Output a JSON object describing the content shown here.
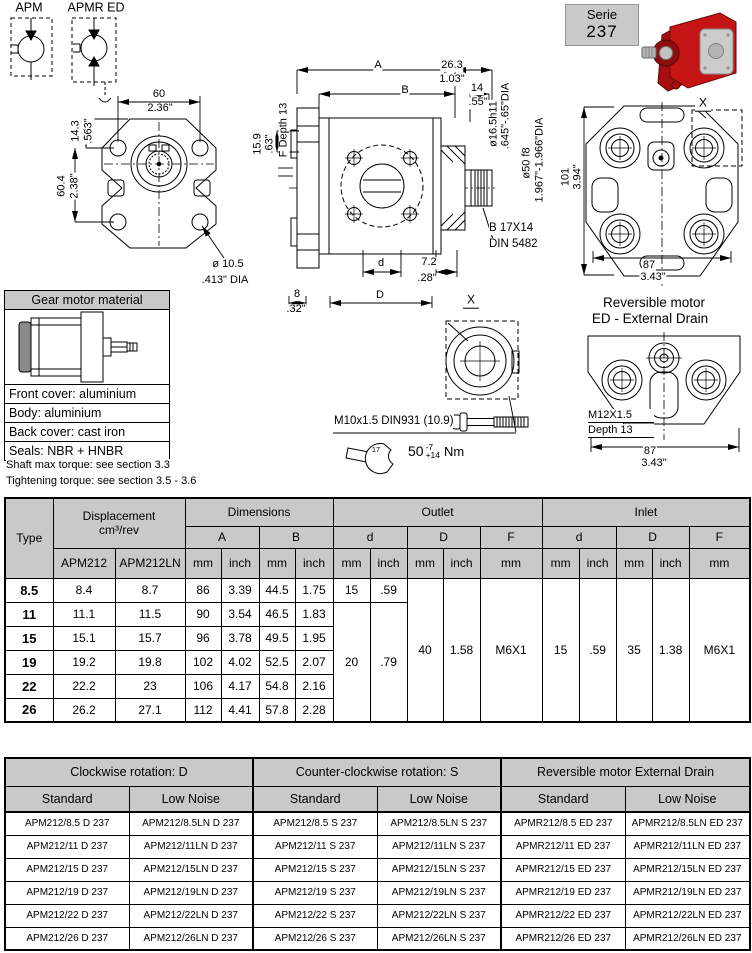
{
  "schematic": {
    "apm_label": "APM",
    "apmr_label": "APMR ED"
  },
  "serie": {
    "label": "Serie",
    "number": "237"
  },
  "front_view": {
    "width_mm": "60",
    "width_in": "2.36\"",
    "offset_mm": "14.3",
    "offset_in": ".563\"",
    "height_mm": "60.4",
    "height_in": "2.38\"",
    "port_offset_mm": "15.9",
    "port_offset_in": ".63\"",
    "f_depth": "F Depth 13",
    "hole_dia_mm": "ø 10.5",
    "hole_dia_in": ".413\" DIA"
  },
  "side_view": {
    "dim_a": "A",
    "dim_b": "B",
    "shaft_ext_mm": "26.3",
    "shaft_ext_in": "1.03\"",
    "spline_len_mm": "14",
    "spline_len_in": ".55\"",
    "shaft_dia": "ø16.5h11",
    "shaft_dia_in": ".645\"-.65\"DIA",
    "pilot_dia": "ø50 f8",
    "pilot_dia_in": "1.967\"-1.966\"DIA",
    "spline_type": "B 17X14",
    "spline_std": "DIN 5482",
    "dim_d": "d",
    "port_depth_mm": "7.2",
    "port_depth_in": ".28\"",
    "base_mm": "8",
    "base_in": ".32\"",
    "dim_D": "D"
  },
  "rear_view": {
    "height_mm": "101",
    "height_in": "3.94\"",
    "width_mm": "87",
    "width_in": "3.43\"",
    "x_label": "X"
  },
  "material_box": {
    "title": "Gear motor material",
    "rows": [
      "Front cover: aluminium",
      "Body: aluminium",
      "Back cover: cast iron",
      "Seals: NBR + HNBR"
    ]
  },
  "notes": {
    "line1": "Shaft max torque: see section 3.3",
    "line2": "Tightening torque: see section 3.5 - 3.6"
  },
  "detail": {
    "x_label": "X",
    "bolt_spec": "M10x1.5 DIN931 (10.9)",
    "wrench_size": "17",
    "torque_value": "50",
    "torque_minus": "-7",
    "torque_plus": "+14",
    "torque_unit": "Nm"
  },
  "reversible": {
    "title_line1": "Reversible motor",
    "title_line2": "ED - External Drain",
    "thread": "M12X1.5",
    "depth": "Depth 13",
    "width_mm": "87",
    "width_in": "3.43\""
  },
  "dim_table": {
    "h_type": "Type",
    "h_displacement": "Displacement",
    "h_displacement_unit": "cm³/rev",
    "h_apm212": "APM212",
    "h_apm212ln": "APM212LN",
    "h_dimensions": "Dimensions",
    "h_outlet": "Outlet",
    "h_inlet": "Inlet",
    "h_a": "A",
    "h_b": "B",
    "h_d": "d",
    "h_D": "D",
    "h_F": "F",
    "h_mm": "mm",
    "h_inch": "inch",
    "rows": [
      {
        "type": "8.5",
        "d1": "8.4",
        "d2": "8.7",
        "a_mm": "86",
        "a_in": "3.39",
        "b_mm": "44.5",
        "b_in": "1.75",
        "od_mm": "15",
        "od_in": ".59"
      },
      {
        "type": "11",
        "d1": "11.1",
        "d2": "11.5",
        "a_mm": "90",
        "a_in": "3.54",
        "b_mm": "46.5",
        "b_in": "1.83"
      },
      {
        "type": "15",
        "d1": "15.1",
        "d2": "15.7",
        "a_mm": "96",
        "a_in": "3.78",
        "b_mm": "49.5",
        "b_in": "1.95"
      },
      {
        "type": "19",
        "d1": "19.2",
        "d2": "19.8",
        "a_mm": "102",
        "a_in": "4.02",
        "b_mm": "52.5",
        "b_in": "2.07"
      },
      {
        "type": "22",
        "d1": "22.2",
        "d2": "23",
        "a_mm": "106",
        "a_in": "4.17",
        "b_mm": "54.8",
        "b_in": "2.16"
      },
      {
        "type": "26",
        "d1": "26.2",
        "d2": "27.1",
        "a_mm": "112",
        "a_in": "4.41",
        "b_mm": "57.8",
        "b_in": "2.28"
      }
    ],
    "merged": {
      "od2_mm": "20",
      "od2_in": ".79",
      "oD_mm": "40",
      "oD_in": "1.58",
      "oF": "M6X1",
      "id_mm": "15",
      "id_in": ".59",
      "iD_mm": "35",
      "iD_in": "1.38",
      "iF": "M6X1"
    }
  },
  "model_table": {
    "group1": "Clockwise rotation: D",
    "group2": "Counter-clockwise rotation: S",
    "group3": "Reversible motor External Drain",
    "sub_standard": "Standard",
    "sub_low_noise": "Low Noise",
    "rows": [
      [
        "APM212/8.5 D 237",
        "APM212/8.5LN D 237",
        "APM212/8.5 S 237",
        "APM212/8.5LN S 237",
        "APMR212/8.5 ED 237",
        "APMR212/8.5LN ED 237"
      ],
      [
        "APM212/11 D 237",
        "APM212/11LN D 237",
        "APM212/11 S 237",
        "APM212/11LN S 237",
        "APMR212/11 ED 237",
        "APMR212/11LN ED 237"
      ],
      [
        "APM212/15 D 237",
        "APM212/15LN D 237",
        "APM212/15 S 237",
        "APM212/15LN S 237",
        "APMR212/15 ED 237",
        "APMR212/15LN ED 237"
      ],
      [
        "APM212/19 D 237",
        "APM212/19LN D 237",
        "APM212/19 S 237",
        "APM212/19LN S 237",
        "APMR212/19 ED 237",
        "APMR212/19LN ED 237"
      ],
      [
        "APM212/22 D 237",
        "APM212/22LN D 237",
        "APM212/22 S 237",
        "APM212/22LN S 237",
        "APMR212/22 ED 237",
        "APMR212/22LN ED 237"
      ],
      [
        "APM212/26 D 237",
        "APM212/26LN D 237",
        "APM212/26 S 237",
        "APM212/26LN S 237",
        "APMR212/26 ED 237",
        "APMR212/26LN ED 237"
      ]
    ]
  }
}
